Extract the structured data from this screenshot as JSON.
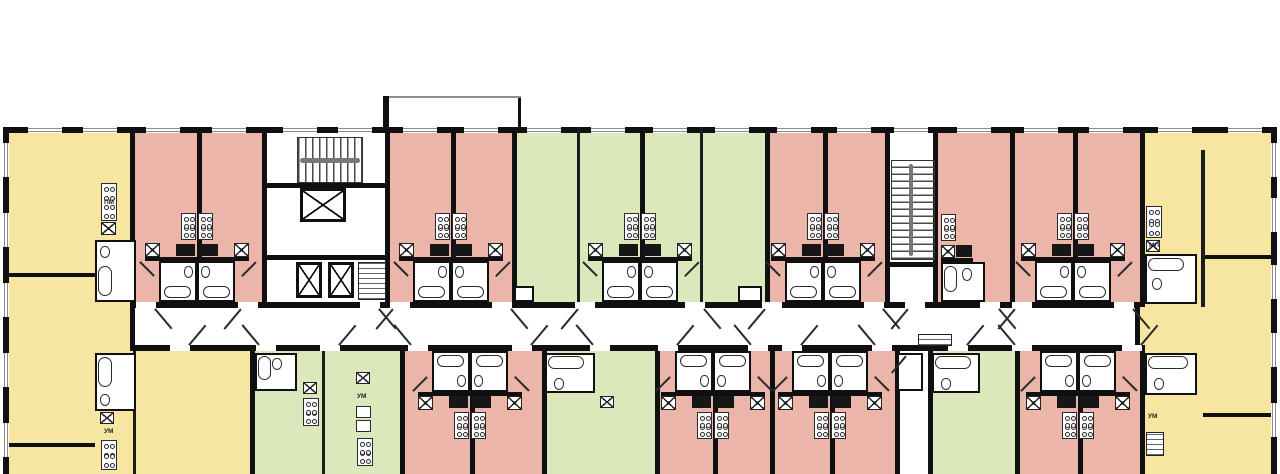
{
  "meta": {
    "title": "Residential storey floor plan",
    "kind": "architectural-floor-plan"
  },
  "colors": {
    "pink": "#ebb5a9",
    "green": "#dbe8bc",
    "yellow": "#f7e5a2",
    "white": "#ffffff",
    "wall": "#101010",
    "corridor": "#ffffff",
    "window_sill": "#8d8d8d"
  },
  "canvas": {
    "w": 1280,
    "h": 474
  },
  "building": {
    "x": 3,
    "y": 127,
    "w": 1274,
    "h": 347
  },
  "corridor": {
    "x": 130,
    "y": 308,
    "w": 1010,
    "h": 37
  },
  "rooms": [
    {
      "n": "unit-west-yellow",
      "x": 3,
      "y": 133,
      "w": 127,
      "h": 341,
      "c": "yellow"
    },
    {
      "n": "unit-west-yellow-south",
      "x": 130,
      "y": 351,
      "w": 120,
      "h": 123,
      "c": "yellow"
    },
    {
      "n": "unit-top-pink-pair-1",
      "x": 130,
      "y": 133,
      "w": 132,
      "h": 169,
      "c": "pink"
    },
    {
      "n": "core-1-lobby",
      "x": 262,
      "y": 133,
      "w": 128,
      "h": 169,
      "c": "white"
    },
    {
      "n": "unit-top-pink-pair-2",
      "x": 390,
      "y": 133,
      "w": 122,
      "h": 169,
      "c": "pink"
    },
    {
      "n": "unit-top-green-block",
      "x": 512,
      "y": 133,
      "w": 253,
      "h": 169,
      "c": "green"
    },
    {
      "n": "unit-top-pink-pair-3",
      "x": 765,
      "y": 133,
      "w": 120,
      "h": 169,
      "c": "pink"
    },
    {
      "n": "core-2-stairwell",
      "x": 885,
      "y": 133,
      "w": 53,
      "h": 169,
      "c": "white"
    },
    {
      "n": "unit-top-pink-block-4",
      "x": 938,
      "y": 133,
      "w": 202,
      "h": 169,
      "c": "pink"
    },
    {
      "n": "unit-east-yellow",
      "x": 1140,
      "y": 133,
      "w": 137,
      "h": 341,
      "c": "yellow"
    },
    {
      "n": "unit-bot-green-1",
      "x": 250,
      "y": 351,
      "w": 150,
      "h": 123,
      "c": "green"
    },
    {
      "n": "unit-bot-pink-pair-1",
      "x": 400,
      "y": 351,
      "w": 142,
      "h": 123,
      "c": "pink"
    },
    {
      "n": "unit-bot-green-2",
      "x": 542,
      "y": 351,
      "w": 113,
      "h": 123,
      "c": "green"
    },
    {
      "n": "unit-bot-pink-pairs-23",
      "x": 655,
      "y": 351,
      "w": 240,
      "h": 123,
      "c": "pink"
    },
    {
      "n": "bot-storage-closet",
      "x": 895,
      "y": 351,
      "w": 33,
      "h": 123,
      "c": "white"
    },
    {
      "n": "unit-bot-green-3",
      "x": 928,
      "y": 351,
      "w": 87,
      "h": 123,
      "c": "green"
    },
    {
      "n": "unit-bot-pink-pair-4",
      "x": 1015,
      "y": 351,
      "w": 125,
      "h": 123,
      "c": "pink"
    }
  ],
  "walls": {
    "outer_top": {
      "x": 3,
      "y": 127,
      "w": 1274,
      "h": 6
    },
    "outer_left": {
      "x": 3,
      "y": 127,
      "w": 6,
      "h": 347
    },
    "outer_right": {
      "x": 1271,
      "y": 127,
      "w": 6,
      "h": 347
    },
    "corridor_top": {
      "x": 130,
      "y": 302,
      "w": 1010,
      "h": 6
    },
    "corridor_bottom": {
      "x": 130,
      "y": 345,
      "w": 1010,
      "h": 6
    },
    "corridor_caps": [
      [
        130,
        302,
        5,
        49
      ],
      [
        1135,
        302,
        5,
        49
      ]
    ],
    "verticals_top": [
      130,
      197,
      262,
      385,
      451,
      512,
      640,
      765,
      823,
      885,
      933,
      1010,
      1073,
      1140
    ],
    "verticals_top_thin": [
      577,
      700
    ],
    "verticals_bottom": [
      250,
      400,
      470,
      542,
      655,
      713,
      770,
      830,
      895,
      928,
      1015,
      1078,
      1140
    ],
    "verticals_bottom_thin": [
      322,
      133
    ],
    "horizontals": [
      [
        262,
        183,
        123,
        5
      ],
      [
        262,
        255,
        123,
        5
      ],
      [
        885,
        262,
        48,
        5
      ],
      [
        9,
        273,
        121,
        4
      ],
      [
        9,
        443,
        86,
        4
      ],
      [
        1203,
        255,
        74,
        4
      ],
      [
        1203,
        413,
        74,
        4
      ]
    ],
    "extra_verticals": [
      [
        1201,
        150,
        4,
        157
      ]
    ],
    "canopy": {
      "stub_left": [
        383,
        96,
        6,
        37
      ],
      "stub_right": [
        518,
        96,
        3,
        37
      ],
      "edge": [
        389,
        96,
        132,
        2
      ]
    }
  },
  "windows": {
    "width": 34,
    "top_centers": [
      45,
      100,
      163,
      229,
      300,
      355,
      420,
      481,
      544,
      608,
      670,
      732,
      794,
      854,
      911,
      974,
      1041,
      1106,
      1175,
      1245
    ],
    "left_centers": [
      160,
      230,
      300,
      370,
      440
    ],
    "right_centers": [
      160,
      215,
      282,
      350,
      420
    ]
  },
  "doors": {
    "gap": 20,
    "top": [
      146,
      248,
      370,
      400,
      502,
      585,
      695,
      772,
      874,
      915,
      990,
      1022,
      1124
    ],
    "bottom": [
      180,
      266,
      330,
      418,
      522,
      600,
      668,
      758,
      792,
      882,
      958,
      1022,
      1132
    ]
  },
  "fixture_pairs": {
    "top": [
      197,
      451,
      640,
      823,
      1073
    ],
    "bottom": [
      470,
      713,
      830,
      1078
    ]
  },
  "single_kitchens_top": [
    {
      "cx": 941
    }
  ],
  "corner_fixtures": {
    "west_top": {
      "stove": [
        101,
        183,
        16,
        38
      ],
      "sink": [
        101,
        222,
        15,
        13
      ],
      "bath": [
        95,
        240,
        41,
        62
      ],
      "tub_v": [
        98,
        266,
        14,
        30
      ],
      "toilet": [
        100,
        246,
        10,
        12
      ]
    },
    "west_bottom": {
      "bath": [
        95,
        353,
        41,
        58
      ],
      "tub_v": [
        98,
        357,
        14,
        30
      ],
      "toilet": [
        100,
        394,
        10,
        12
      ],
      "sink": [
        100,
        412,
        14,
        12
      ],
      "stove": [
        101,
        440,
        16,
        30
      ]
    },
    "east_top": {
      "stove": [
        1146,
        206,
        16,
        32
      ],
      "sink": [
        1146,
        240,
        14,
        12
      ],
      "bath": [
        1145,
        254,
        52,
        50
      ],
      "tub_h": [
        1148,
        258,
        36,
        13
      ],
      "toilet": [
        1152,
        278,
        10,
        12
      ]
    },
    "east_bottom": {
      "bath": [
        1145,
        353,
        52,
        42
      ],
      "tub_h": [
        1148,
        356,
        40,
        13
      ],
      "toilet": [
        1154,
        378,
        10,
        12
      ],
      "hatch": [
        1146,
        432,
        18,
        24
      ]
    }
  },
  "green_fixtures": [
    {
      "bath": [
        255,
        353,
        42,
        38
      ],
      "tub_v": [
        258,
        356,
        13,
        24
      ],
      "toilet": [
        272,
        358,
        10,
        12
      ],
      "stove": [
        303,
        398,
        16,
        28
      ],
      "sink": [
        303,
        382,
        14,
        12
      ]
    },
    {
      "bath": [
        545,
        353,
        50,
        40
      ],
      "tub_h": [
        548,
        356,
        36,
        13
      ],
      "toilet": [
        554,
        378,
        10,
        12
      ],
      "sink": [
        600,
        396,
        14,
        12
      ]
    },
    {
      "bath": [
        932,
        353,
        48,
        40
      ],
      "tub_h": [
        935,
        356,
        36,
        13
      ],
      "toilet": [
        941,
        378,
        10,
        12
      ]
    }
  ],
  "kitchen_strip": {
    "sink": [
      356,
      372,
      14,
      12
    ],
    "box1": [
      356,
      406,
      15,
      12
    ],
    "box2": [
      356,
      420,
      15,
      12
    ],
    "stove": [
      357,
      438,
      16,
      28
    ]
  },
  "green_corner_boxes": [
    [
      514,
      286,
      20,
      16
    ],
    [
      738,
      286,
      24,
      16
    ]
  ],
  "cores": {
    "stairs_h": {
      "box": [
        297,
        137,
        66,
        46
      ],
      "rail": [
        300,
        158,
        60,
        5
      ]
    },
    "elevator_large": [
      300,
      188,
      46,
      34
    ],
    "elevators_small": [
      [
        296,
        262,
        26,
        36
      ],
      [
        328,
        262,
        26,
        36
      ]
    ],
    "hatch_1": [
      358,
      262,
      28,
      38
    ],
    "stairs_v": {
      "box": [
        891,
        160,
        44,
        100
      ],
      "rail": [
        909,
        164,
        4,
        92
      ]
    },
    "hatch_2": [
      918,
      334,
      34,
      12
    ],
    "closet": [
      897,
      353,
      26,
      38
    ]
  },
  "text_labels": [
    {
      "text": "ПМ",
      "x": 104,
      "y": 200
    },
    {
      "text": "МП",
      "x": 1149,
      "y": 243
    },
    {
      "text": "УМ",
      "x": 104,
      "y": 429
    },
    {
      "text": "УМ",
      "x": 357,
      "y": 394
    },
    {
      "text": "УМ",
      "x": 1148,
      "y": 414
    }
  ]
}
